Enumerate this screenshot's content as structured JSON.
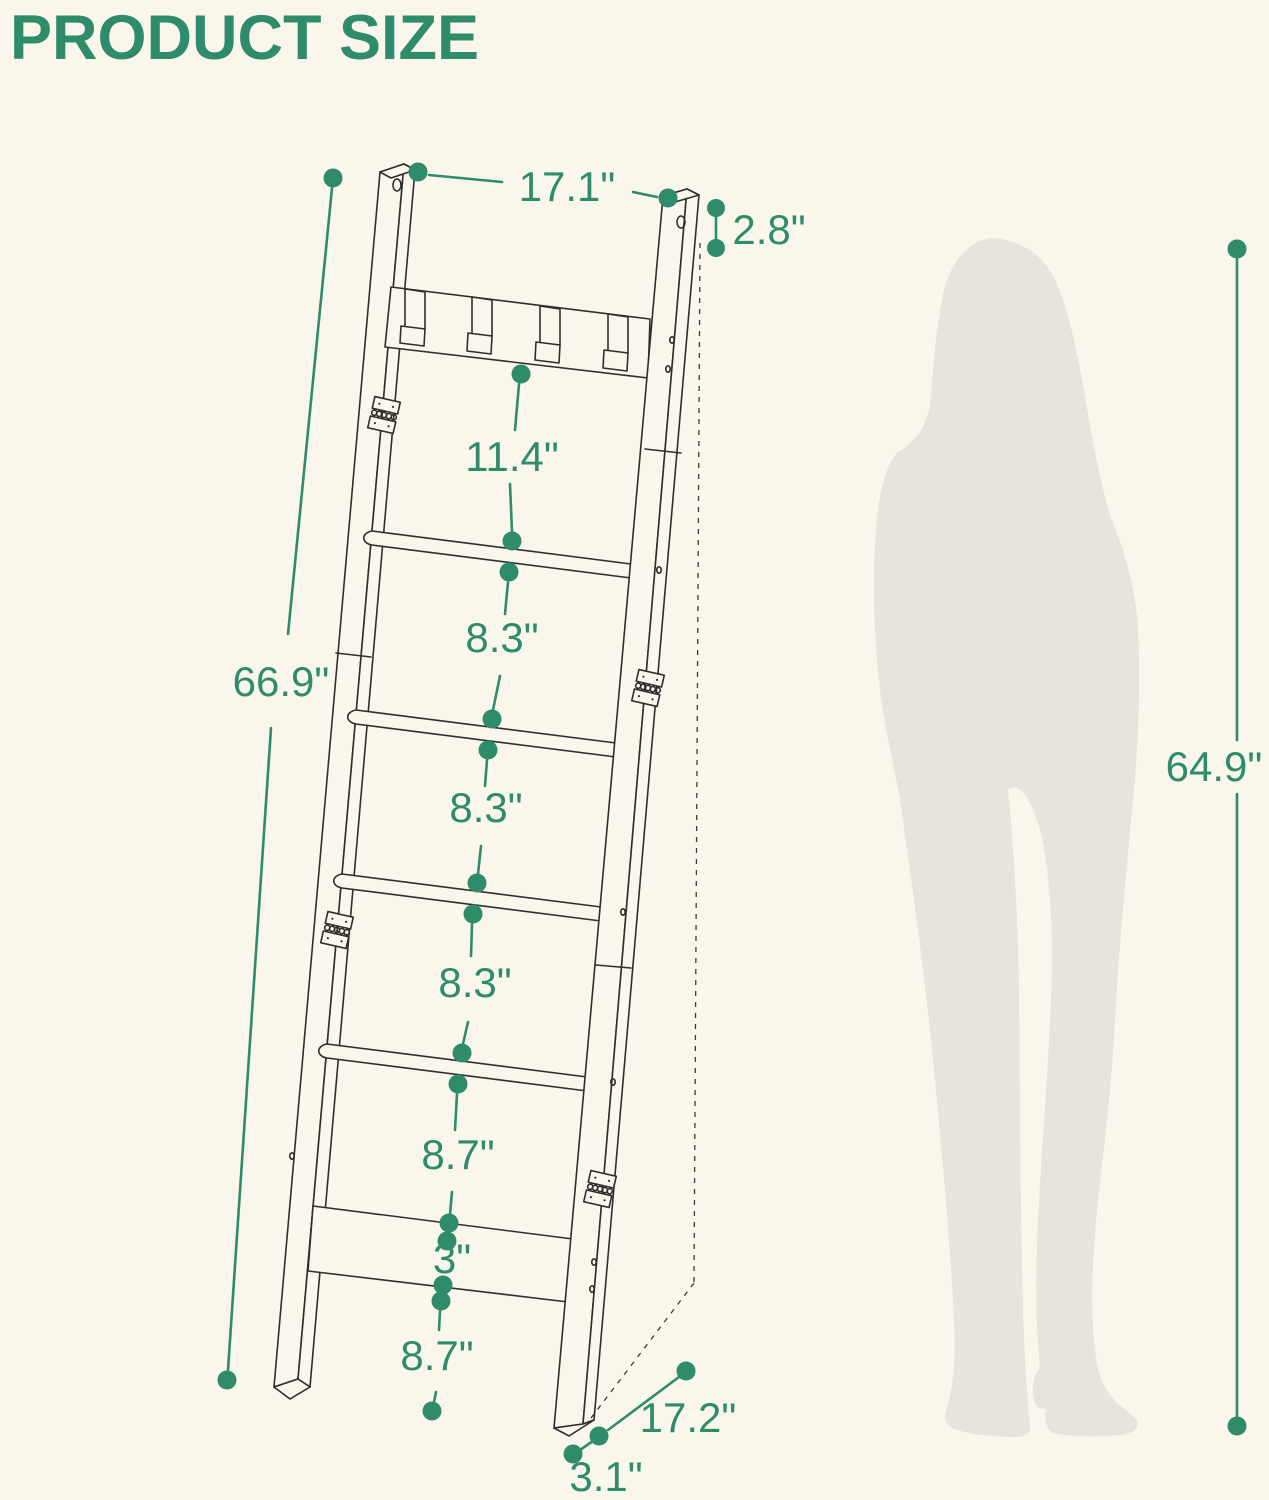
{
  "title": "PRODUCT SIZE",
  "colors": {
    "background": "#FAF6EC",
    "accent_green": "#2E8C6A",
    "drawing_line": "#2E2E2E",
    "silhouette_gray": "#E6E4DC"
  },
  "diagram": {
    "type": "product-dimension-diagram",
    "subject": "leaning blanket ladder with top hooks",
    "figure": "human-silhouette-for-scale"
  },
  "dimensions": {
    "top_width": "17.1\"",
    "top_end_offset": "2.8\"",
    "hooks_to_first_rung": "11.4\"",
    "rung_gap_1": "8.3\"",
    "rung_gap_2": "8.3\"",
    "rung_gap_3": "8.3\"",
    "rung_gap_4": "8.7\"",
    "shelf_thickness": "3\"",
    "bottom_clearance": "8.7\"",
    "ladder_length": "66.9\"",
    "standing_height": "64.9\"",
    "base_depth": "17.2\"",
    "foot_depth": "3.1\""
  }
}
